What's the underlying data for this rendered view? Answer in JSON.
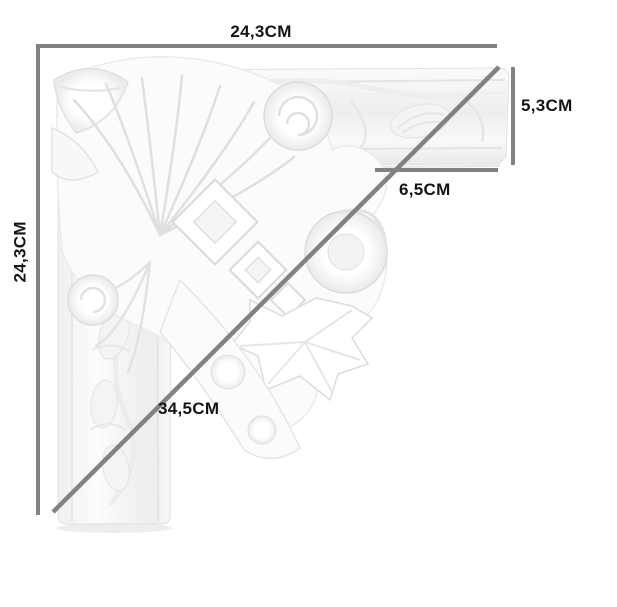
{
  "diagram": {
    "background_color": "#ffffff",
    "dimension_line_color": "#828282",
    "label_color": "#141414",
    "labels": {
      "top_width": "24,3CM",
      "left_height": "24,3CM",
      "right_profile_height": "5,3CM",
      "inner_profile_width": "6,5CM",
      "diagonal_length": "34,5CM"
    }
  }
}
